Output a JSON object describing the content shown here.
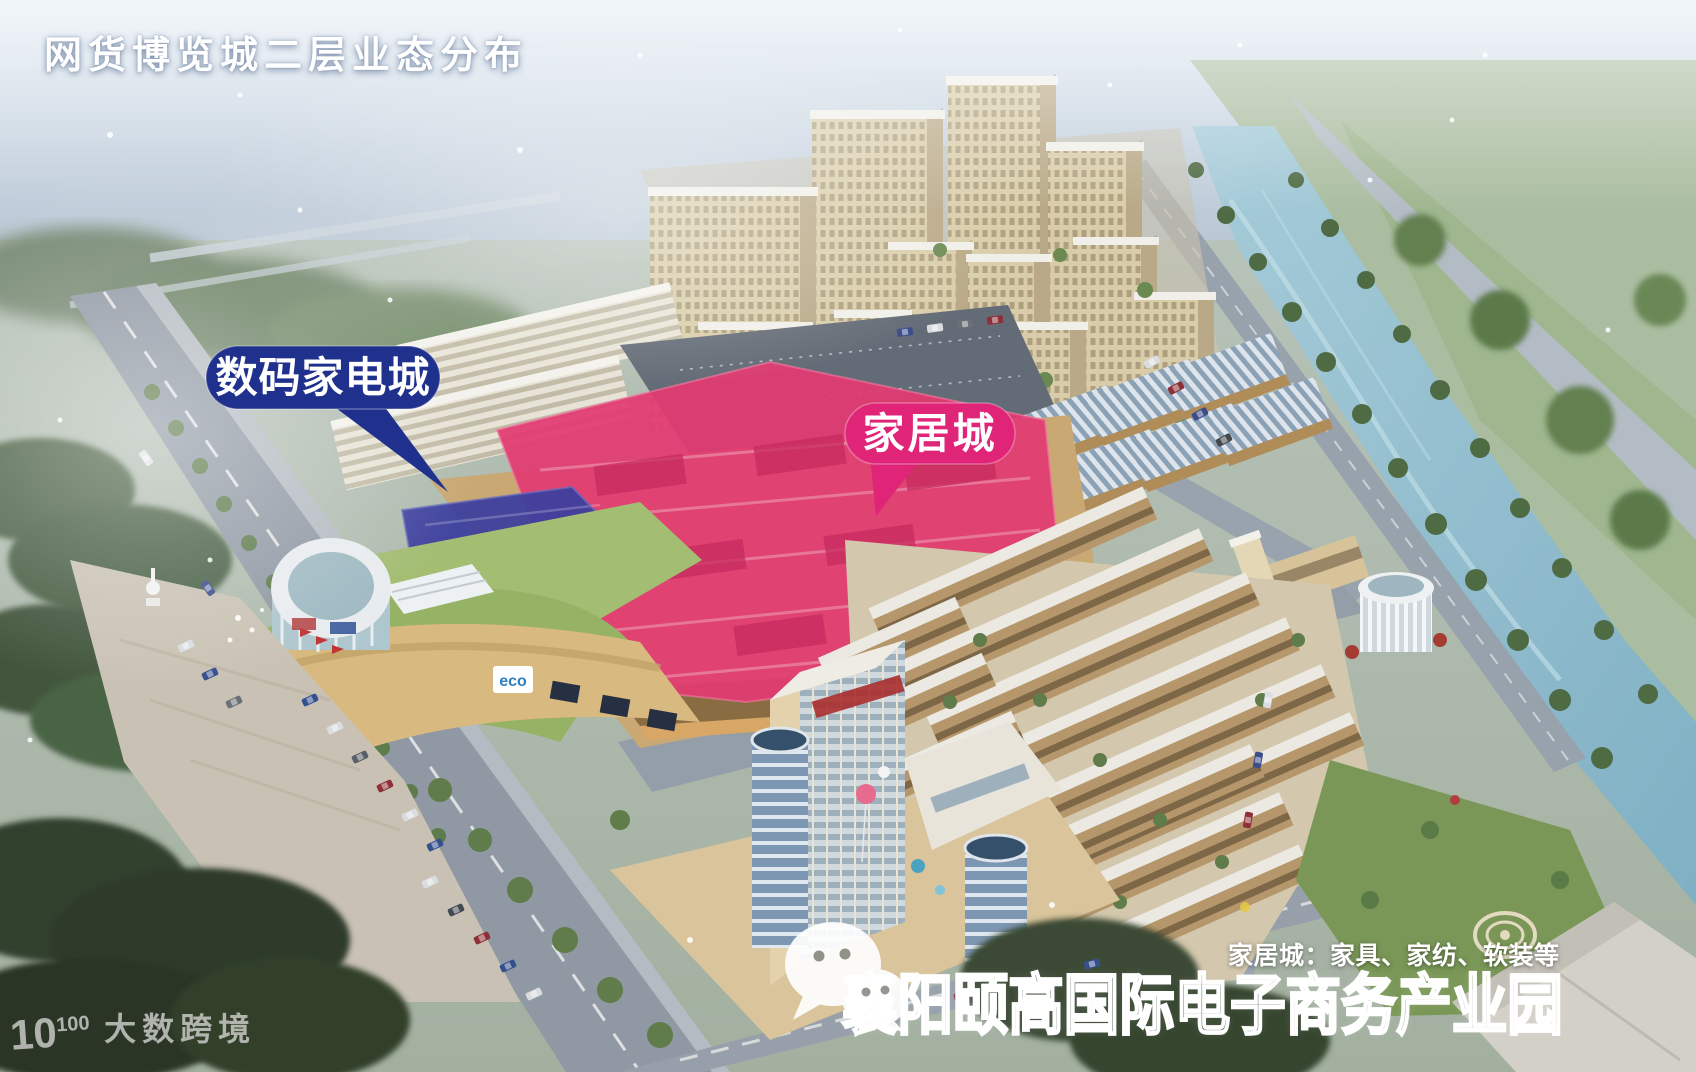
{
  "title": "网货博览城二层业态分布",
  "callouts": {
    "digital": {
      "label": "数码家电城",
      "fill": "#1f318d"
    },
    "home": {
      "label": "家居城",
      "fill": "#e02478"
    }
  },
  "zones": {
    "home_roof": {
      "name": "家居城屋面",
      "fill": "#e23a72"
    },
    "digital_roof": {
      "name": "数码家电城屋面",
      "fill": "#3b3f9d"
    }
  },
  "caption": "家居城：家具、家纺、软装等",
  "park_name": "襄阳颐高国际电子商务产业园",
  "signs": {
    "eco": "eco"
  },
  "watermark": {
    "logo_base": "10",
    "logo_exponent": "100",
    "brand": "大数跨境"
  },
  "icons": {
    "wechat": "wechat-chat-bubbles"
  },
  "colors": {
    "sky_haze": "#d7e3ee",
    "river": "#8fbccd",
    "label_digital": "#1f318d",
    "label_home": "#e02478",
    "zone_home": "#e23a72",
    "zone_digital": "#3b3f9d"
  }
}
